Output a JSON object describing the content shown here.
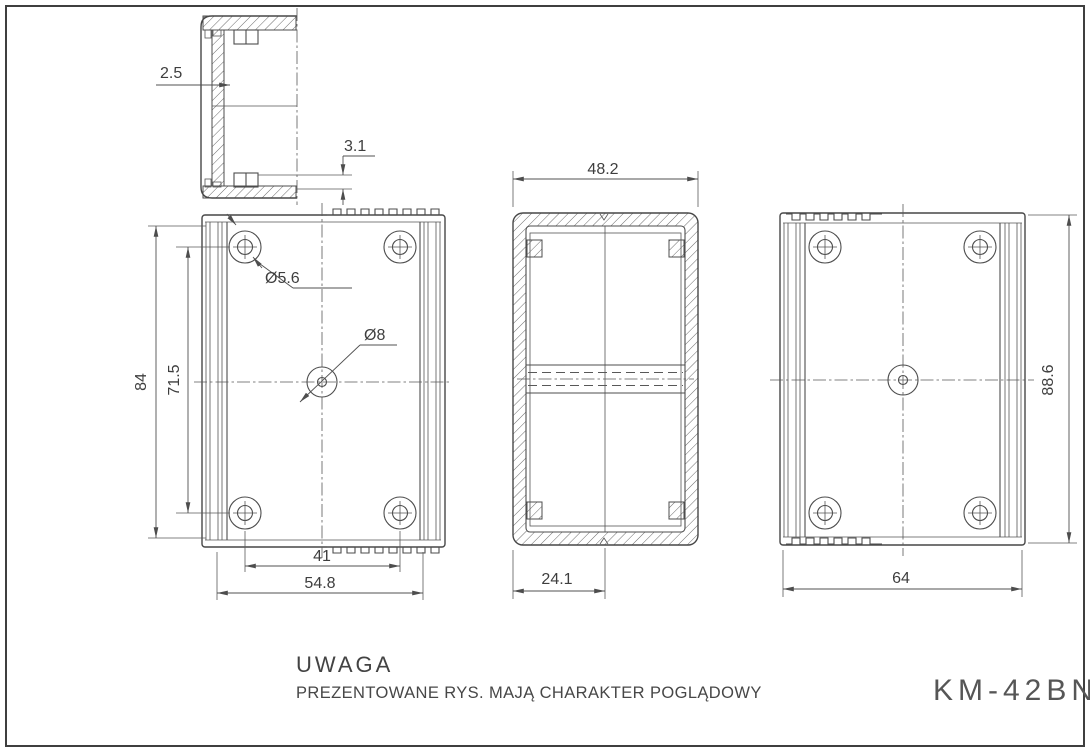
{
  "page": {
    "background": "#ffffff",
    "frame_color": "#3f3f3f",
    "line_color": "#4d4d4d"
  },
  "notes": {
    "title": "UWAGA",
    "body": "PREZENTOWANE RYS. MAJĄ CHARAKTER POGLĄDOWY"
  },
  "title_block": {
    "model": "KM-42BN"
  },
  "dimensions": {
    "section_side": {
      "wall_thickness": "2.5",
      "rim_height": "3.1"
    },
    "view_bottom": {
      "body_height": "84",
      "hole_pitch_vertical": "71.5",
      "corner_hole_diameter": "Ø5.6",
      "center_hole_diameter": "Ø8",
      "hole_pitch_horizontal": "41",
      "base_width": "54.8"
    },
    "section_end": {
      "overall_depth": "48.2",
      "base_to_center": "24.1"
    },
    "view_top": {
      "overall_height": "88.6",
      "overall_width": "64"
    }
  }
}
